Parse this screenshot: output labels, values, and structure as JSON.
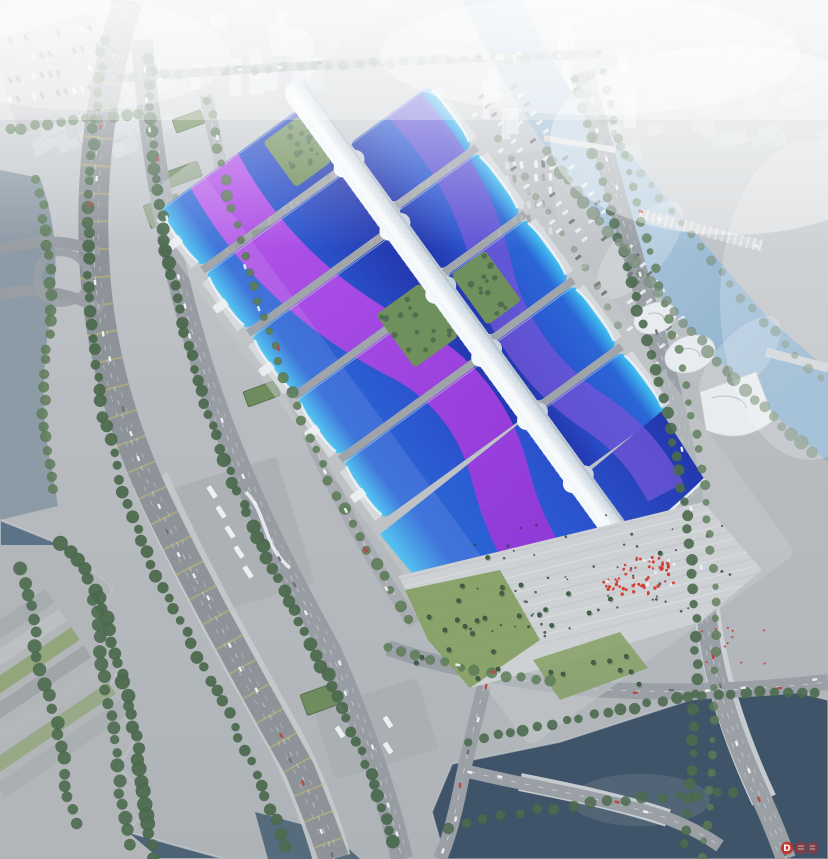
{
  "scene": {
    "type": "aerial-architectural-rendering",
    "subject": "large exhibition and convention center complex",
    "description": "Oblique bird's-eye rendering of a mega exhibition center: two columns of standard exhibition halls with sapphire-blue wave roofs crossed by magenta-violet ribbon bands, joined by a white serpentine central concourse spine that ends in a shell-shaped scoop above a wave-roofed entrance hall. A stepped arrival plaza with palm trees and a red crowd cluster sits to the south. The site is ringed by an elevated expressway, arterial roads, coach parks, tree-lined avenues, canals and rivers, with a hazy white city skyline fading into fog to the north.",
    "lighting": "hazy daylight, white atmospheric fog toward the horizon"
  },
  "palette": {
    "groundTop": "#ced3d7",
    "groundMid": "#b9bdc1",
    "groundLow": "#aeb3b7",
    "cityBlock": "#d6dbdf",
    "cityEdge": "#c2c8ce",
    "towerLight": "#e3e7eb",
    "fogWhite": "#f7f9fa",
    "riverBlue": "#a9c4da",
    "riverDeep": "#8db1cd",
    "canalBlue": "#9db9ce",
    "leftRiver": "#8d9ba6",
    "lakeDark": "#4d6375",
    "lakeLight": "#5d7488",
    "pondDark": "#3f5468",
    "bankEdge": "#c9cdd0",
    "roadAsphalt": "#979da3",
    "roadDark": "#8d9399",
    "roadEdge": "#868d93",
    "laneWhite": "#e8eaec",
    "laneYellow": "#cfc06a",
    "treeDark": "#4d6b4f",
    "treeMid": "#5e7d58",
    "treeHazy": "#7d917c",
    "lawn": "#85a065",
    "lawnDark": "#6f8f5d",
    "greenRoof": "#708c5e",
    "palmGreen": "#2f4a35",
    "hallCyan": "#41c0f0",
    "hallBlue": "#2b66d6",
    "hallDeep": "#2337ae",
    "hallMid": "#2b55cf",
    "ribbonMagenta": "#c258ec",
    "ribbonMagentaDeep": "#9333d6",
    "ribbonViolet": "#6f55d6",
    "rimWhite": "#eaf2f7",
    "facade": "#d8dbdd",
    "facadeShadow": "#878d93",
    "spineLight": "#f6fafc",
    "spineMid": "#e7eef3",
    "spineShade": "#c2cdd7",
    "plaza": "#cdd1d4",
    "plazaLine": "#dde0e2",
    "crowdRed": "#d23428",
    "carWhite": "#f0f2f4",
    "carDark": "#6b7075",
    "peopleDark": "#3a3f45",
    "watermarkRed": "#c8281e",
    "landmarkWhite": "#e8ecef"
  },
  "elements": {
    "complex": {
      "west_hall_rows": 5,
      "east_hall_rows": 5,
      "central_spine": "white serpentine concourse canopy with diamond panel texture",
      "entrance_hall": "wave-shaped blue roof with white scoop beak",
      "roof_style": "blue gradient shells with cyan rims and purple ribbon graphics",
      "courtyards": "green roof gardens beside the spine"
    },
    "plaza": {
      "features": [
        "stepped paving",
        "palm trees",
        "red crowd cluster",
        "scattered visitors"
      ]
    },
    "water": [
      "north canal",
      "east river with bridges",
      "west channel",
      "southwest lake",
      "south pond"
    ],
    "roads": [
      "elevated expressway",
      "arterial avenue with coach bays",
      "east riverside avenue",
      "south cross streets",
      "interchange ramps"
    ],
    "city": [
      "foggy tower skyline",
      "dome hall",
      "low industrial grid blocks"
    ],
    "vehicles": [
      "cars",
      "coaches",
      "parked car rows"
    ]
  },
  "watermark": {
    "logo_letter": "D"
  }
}
